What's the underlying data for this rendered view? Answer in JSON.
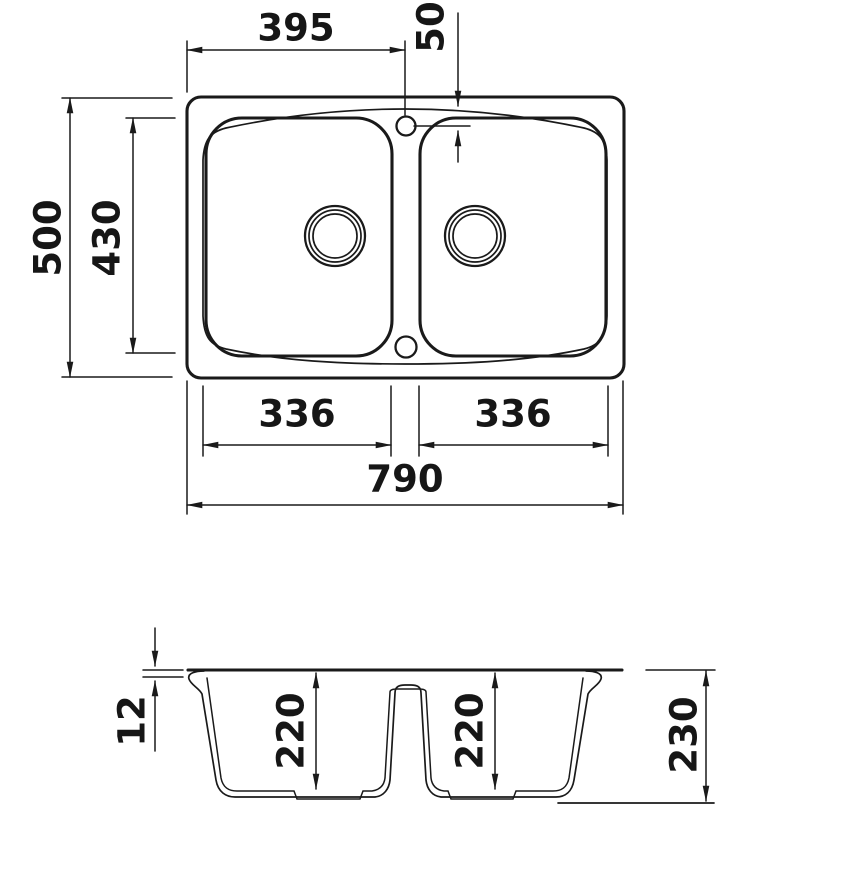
{
  "drawing": {
    "type": "sink-technical-drawing",
    "views": [
      "top-view",
      "section-view"
    ],
    "colors": {
      "line": "#1a1a1a",
      "background": "#ffffff"
    }
  },
  "dims": {
    "width_to_faucet": "395",
    "faucet_from_top_edge": "50",
    "overall_depth": "500",
    "bowl_length": "430",
    "left_bowl_width": "336",
    "right_bowl_width": "336",
    "overall_width": "790",
    "rim_thickness": "12",
    "left_bowl_depth": "220",
    "right_bowl_depth": "220",
    "overall_height": "230"
  }
}
